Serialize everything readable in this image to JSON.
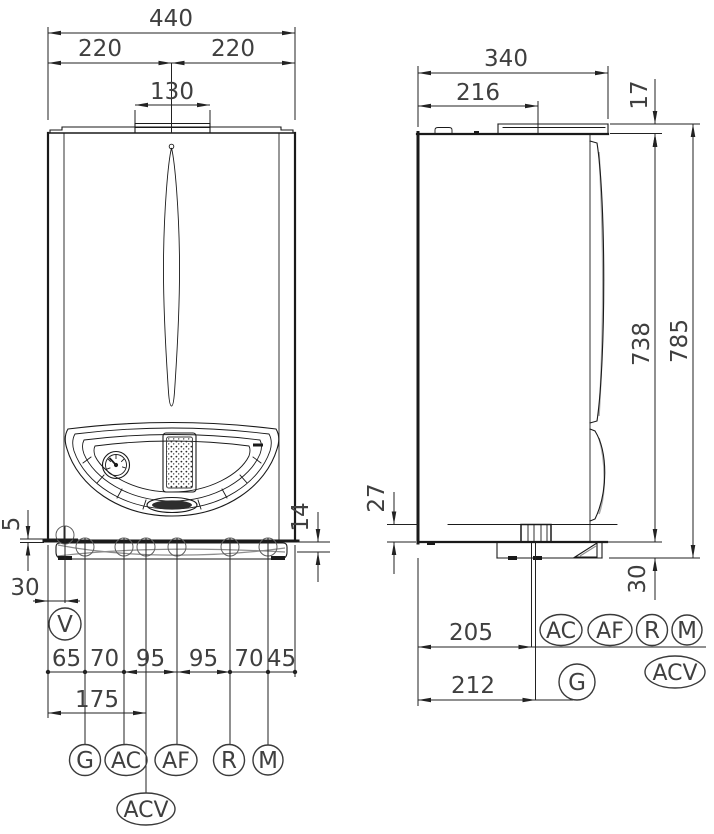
{
  "style": {
    "line_color": "#1a1a1a",
    "dimension_text_color": "#3f3f3f",
    "background": "#ffffff"
  },
  "front_view": {
    "dim_total_width": "440",
    "dim_left_half": "220",
    "dim_right_half": "220",
    "dim_flue_width": "130",
    "dim_edge_gap": "5",
    "dim_valve_offset": "30",
    "dim_tray_height": "14",
    "dim_acv_offset": "175",
    "spacing": [
      "65",
      "70",
      "95",
      "95",
      "70",
      "45"
    ],
    "connections": {
      "v": "V",
      "g": "G",
      "ac": "AC",
      "af": "AF",
      "r": "R",
      "m": "M",
      "acv": "ACV"
    }
  },
  "side_view": {
    "dim_total_depth": "340",
    "dim_flue_center": "216",
    "dim_top_plate": "17",
    "dim_body_height": "738",
    "dim_total_height": "785",
    "dim_gas_offset": "27",
    "dim_tray_height": "30",
    "dim_conn_depth": "205",
    "dim_gas_depth": "212",
    "connections": {
      "ac": "AC",
      "af": "AF",
      "r": "R",
      "m": "M",
      "acv": "ACV",
      "g": "G"
    }
  }
}
